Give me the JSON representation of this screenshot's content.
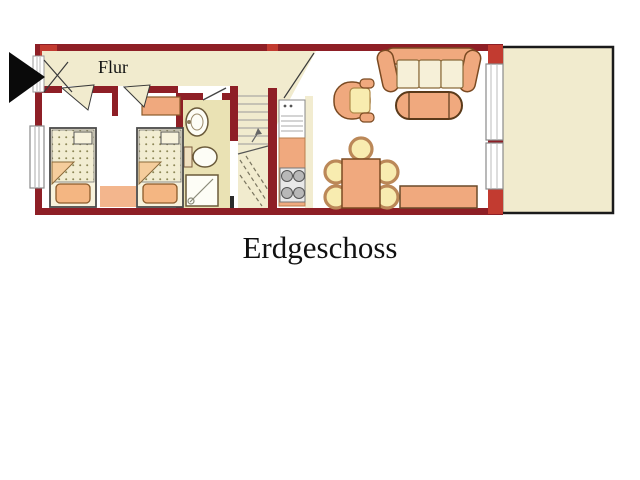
{
  "floor_plan": {
    "title": "Erdgeschoss",
    "hallway_label": "Flur",
    "rooms": [
      "hallway",
      "bedroom-left",
      "bedroom-right",
      "bathroom",
      "staircase",
      "kitchen",
      "living-dining-room",
      "terrace"
    ],
    "furniture": {
      "bedroom_left": [
        "single-bed-with-dotted-blanket",
        "pillow"
      ],
      "bedroom_right": [
        "single-bed-with-dotted-blanket",
        "pillow",
        "dresser",
        "rug"
      ],
      "bathroom": [
        "washbasin",
        "toilet",
        "shower-cabin"
      ],
      "kitchen": [
        "fridge-sink-unit",
        "counter",
        "stove-four-burners"
      ],
      "living_dining_room": [
        "three-seat-sofa",
        "tub-armchair",
        "oval-coffee-table",
        "dining-table",
        "five-dining-chairs",
        "sideboard"
      ],
      "staircase": [
        "stairs-up-with-break-line"
      ]
    },
    "entrance_marker": "black-arrow-pointing-right",
    "windows": [
      "left-wall-window",
      "entrance-door-left",
      "right-wall-window-upper",
      "right-wall-window-lower"
    ]
  },
  "colors": {
    "wall": "#8E1F26",
    "wall_bright": "#C23B30",
    "floor_beige": "#F1EBCE",
    "floor_khaki": "#EAE2B4",
    "furniture_salmon": "#F0A97E",
    "furniture_cream": "#F6F0D8",
    "seat_yellow": "#F8ECB0",
    "outline_brown": "#7A4A22",
    "text": "#111111"
  }
}
